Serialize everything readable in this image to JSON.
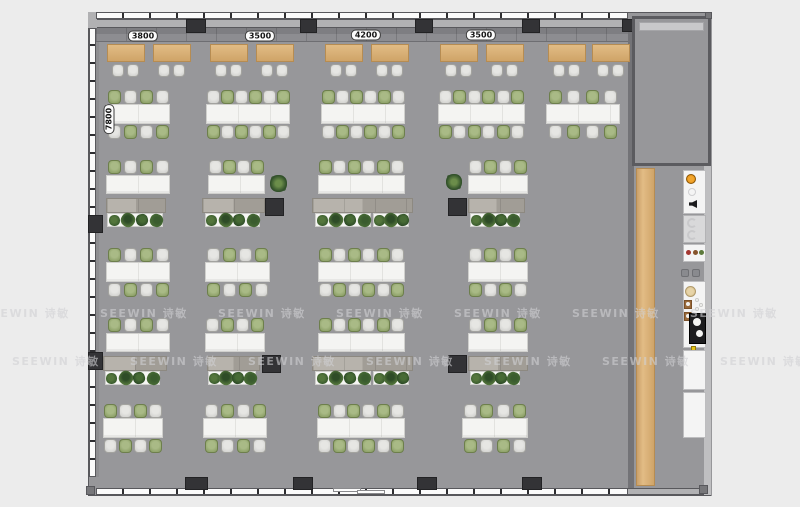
{
  "watermark": {
    "text": "SEEWIN 诗敏",
    "color": "rgba(208,208,212,0.6)",
    "rows": [
      {
        "y": 305,
        "offset": -18
      },
      {
        "y": 353,
        "offset": 12
      }
    ],
    "step": 118,
    "count": 8
  },
  "dimensions": {
    "top_labels": [
      {
        "text": "3800",
        "cx": 143,
        "cy": 36
      },
      {
        "text": "3500",
        "cx": 260,
        "cy": 36
      },
      {
        "text": "4200",
        "cx": 366,
        "cy": 35
      },
      {
        "text": "3500",
        "cx": 481,
        "cy": 35
      }
    ],
    "left_labels": [
      {
        "text": "7800",
        "cx": 109,
        "cy": 119
      }
    ]
  },
  "palette": {
    "bg": "#ececec",
    "floor": "#97979a",
    "wall": "#b1b1b3",
    "wall_dark": "#58585c",
    "glass": "#fbfbfb",
    "tick": "#2e2e31",
    "column": "#333336",
    "bench_a": "#7e7e82",
    "bench_b": "#8d8d91",
    "wood_light": "#e2bc85",
    "wood_dark": "#cfa468",
    "wood_border": "#b68c52",
    "desk": "#f4f4f2",
    "desk_border": "#d0d0cd",
    "desk_seam": "#e2e2df",
    "chair_gray": "#d6d6d3",
    "chair_gray_border": "#a3a39f",
    "chair_green": "#92a56d",
    "chair_green_border": "#6d7f4c",
    "cabinet_a": "#b7b3ac",
    "cabinet_b": "#a19d96",
    "cabinet_border": "#8d8981",
    "planter": "#f6f6f4",
    "planter_border": "#cfcfcc",
    "plant_colors": [
      "#3a5c2e",
      "#54763c",
      "#2e4c27",
      "#476b35"
    ],
    "room_wall": "#5b5b5f",
    "whiteboard": "#c8c8ca",
    "white_unit": "#f4f4f4",
    "gray_unit": "#d9d9da",
    "accent_orange": "#e08a10",
    "accent_beige": "#d8c08c",
    "accent_yellow": "#e6c415",
    "stove_black": "#1c1c1e"
  },
  "floorplan": {
    "canvas": {
      "w": 800,
      "h": 507
    },
    "floor": {
      "x": 88,
      "y": 12,
      "w": 624,
      "h": 484
    },
    "outline": {
      "x": 88,
      "y": 12,
      "w": 623,
      "h": 484
    },
    "walls": [
      {
        "name": "wall-top",
        "x": 88,
        "y": 19,
        "w": 546,
        "h": 9,
        "fill": "wall",
        "edges": true
      },
      {
        "name": "wall-left-corner",
        "x": 88,
        "y": 12,
        "w": 9,
        "h": 16,
        "fill": "wall",
        "edges": false
      },
      {
        "name": "wall-left-inner",
        "x": 96,
        "y": 28,
        "w": 3,
        "h": 449,
        "fill": "#8e8e91",
        "edges": false
      },
      {
        "name": "wall-right-main",
        "x": 628,
        "y": 28,
        "w": 6,
        "h": 460,
        "fill": "#737377",
        "edges": false
      },
      {
        "name": "wall-bottom-right",
        "x": 628,
        "y": 488,
        "w": 77,
        "h": 7,
        "fill": "wall",
        "edges": true
      },
      {
        "name": "wall-right-outer",
        "x": 704,
        "y": 16,
        "w": 7,
        "h": 480,
        "fill": "#bfbfc1",
        "edges": true
      }
    ],
    "glass": [
      {
        "name": "window-wall-top",
        "x": 96,
        "y": 12,
        "w": 532,
        "h": 7,
        "dir": "h",
        "seg": 27
      },
      {
        "name": "window-wall-left",
        "x": 89,
        "y": 28,
        "w": 7,
        "h": 449,
        "dir": "v",
        "seg": 18
      },
      {
        "name": "window-wall-bottom",
        "x": 96,
        "y": 488,
        "w": 532,
        "h": 7,
        "dir": "h",
        "seg": 27
      }
    ],
    "columns": [
      {
        "x": 186,
        "y": 19,
        "w": 20,
        "h": 14
      },
      {
        "x": 300,
        "y": 19,
        "w": 17,
        "h": 14
      },
      {
        "x": 415,
        "y": 19,
        "w": 18,
        "h": 14
      },
      {
        "x": 522,
        "y": 19,
        "w": 18,
        "h": 14
      },
      {
        "x": 622,
        "y": 19,
        "w": 12,
        "h": 13
      },
      {
        "x": 185,
        "y": 477,
        "w": 23,
        "h": 13
      },
      {
        "x": 293,
        "y": 477,
        "w": 20,
        "h": 13
      },
      {
        "x": 417,
        "y": 477,
        "w": 20,
        "h": 13
      },
      {
        "x": 522,
        "y": 477,
        "w": 20,
        "h": 13
      },
      {
        "x": 88,
        "y": 215,
        "w": 15,
        "h": 18
      },
      {
        "x": 88,
        "y": 352,
        "w": 15,
        "h": 18
      },
      {
        "x": 265,
        "y": 198,
        "w": 19,
        "h": 18
      },
      {
        "x": 448,
        "y": 198,
        "w": 19,
        "h": 18
      },
      {
        "x": 262,
        "y": 355,
        "w": 19,
        "h": 18
      },
      {
        "x": 448,
        "y": 355,
        "w": 19,
        "h": 18
      }
    ],
    "bench": {
      "x": 96,
      "y": 28,
      "w": 532,
      "h": 14
    },
    "cafe_tables": {
      "y": 44,
      "w": 38,
      "h": 18,
      "chair_y": 64,
      "xs": [
        107,
        153,
        210,
        256,
        325,
        371,
        440,
        486,
        548,
        592
      ]
    },
    "bench_rows": [
      {
        "y": 90,
        "clusters": [
          {
            "x": 106,
            "w": 64,
            "n": 4
          },
          {
            "x": 206,
            "w": 84,
            "n": 6
          },
          {
            "x": 321,
            "w": 84,
            "n": 6
          },
          {
            "x": 438,
            "w": 87,
            "n": 6
          },
          {
            "x": 546,
            "w": 74,
            "n": 4
          }
        ]
      },
      {
        "y": 248,
        "clusters": [
          {
            "x": 106,
            "w": 64,
            "n": 4
          },
          {
            "x": 205,
            "w": 65,
            "n": 4
          },
          {
            "x": 318,
            "w": 87,
            "n": 6
          },
          {
            "x": 468,
            "w": 60,
            "n": 4
          }
        ]
      },
      {
        "y": 404,
        "clusters": [
          {
            "x": 103,
            "w": 60,
            "n": 4
          },
          {
            "x": 203,
            "w": 64,
            "n": 4
          },
          {
            "x": 317,
            "w": 88,
            "n": 6
          },
          {
            "x": 462,
            "w": 66,
            "n": 4
          }
        ]
      }
    ],
    "focus_rows": [
      {
        "y": 160,
        "clusters": [
          {
            "x": 106,
            "w": 64,
            "n": 4
          },
          {
            "x": 208,
            "w": 57,
            "n": 4
          },
          {
            "x": 318,
            "w": 87,
            "n": 6
          },
          {
            "x": 468,
            "w": 60,
            "n": 4
          }
        ],
        "cabinets": [
          {
            "x": 106,
            "w": 60
          },
          {
            "x": 202,
            "w": 63
          },
          {
            "x": 312,
            "w": 101
          },
          {
            "x": 468,
            "w": 57
          }
        ],
        "planters": [
          {
            "x": 107,
            "w": 56,
            "n": 4
          },
          {
            "x": 205,
            "w": 55,
            "n": 4
          },
          {
            "x": 315,
            "w": 56,
            "n": 4
          },
          {
            "x": 373,
            "w": 36,
            "n": 3
          },
          {
            "x": 470,
            "w": 50,
            "n": 4
          }
        ]
      },
      {
        "y": 318,
        "clusters": [
          {
            "x": 106,
            "w": 64,
            "n": 4
          },
          {
            "x": 205,
            "w": 60,
            "n": 4
          },
          {
            "x": 318,
            "w": 87,
            "n": 6
          },
          {
            "x": 468,
            "w": 60,
            "n": 4
          }
        ],
        "cabinets": [
          {
            "x": 103,
            "w": 64
          },
          {
            "x": 207,
            "w": 53
          },
          {
            "x": 312,
            "w": 101
          },
          {
            "x": 468,
            "w": 60
          }
        ],
        "planters": [
          {
            "x": 105,
            "w": 55,
            "n": 4
          },
          {
            "x": 208,
            "w": 48,
            "n": 4
          },
          {
            "x": 315,
            "w": 56,
            "n": 4
          },
          {
            "x": 373,
            "w": 36,
            "n": 3
          },
          {
            "x": 470,
            "w": 50,
            "n": 4
          }
        ]
      }
    ],
    "floor_plants": [
      {
        "x": 270,
        "y": 175,
        "d": 17
      },
      {
        "x": 446,
        "y": 174,
        "d": 16
      }
    ],
    "meeting_room": {
      "x": 632,
      "y": 16,
      "w": 79,
      "h": 150,
      "board": {
        "dx": 7,
        "dy": 6,
        "h": 9
      }
    },
    "wood_counter": {
      "x": 636,
      "y": 168,
      "w": 19,
      "h": 318
    },
    "kitchen": {
      "x": 683,
      "w": 23,
      "items": [
        {
          "type": "coffee",
          "y": 170,
          "h": 44
        },
        {
          "type": "sink",
          "y": 215,
          "h": 28
        },
        {
          "type": "supplies",
          "y": 244,
          "h": 18
        },
        {
          "type": "cups",
          "y": 269,
          "h": 10
        },
        {
          "type": "cook",
          "y": 281,
          "h": 67
        },
        {
          "type": "counter",
          "y": 350,
          "h": 40
        },
        {
          "type": "counter",
          "y": 392,
          "h": 46
        }
      ]
    },
    "door": {
      "x": 333,
      "y": 488,
      "w": 52
    },
    "corner_dots": [
      {
        "x": 86,
        "y": 486,
        "s": 9
      },
      {
        "x": 699,
        "y": 485,
        "s": 9
      },
      {
        "x": 705,
        "y": 12,
        "s": 7
      }
    ]
  }
}
